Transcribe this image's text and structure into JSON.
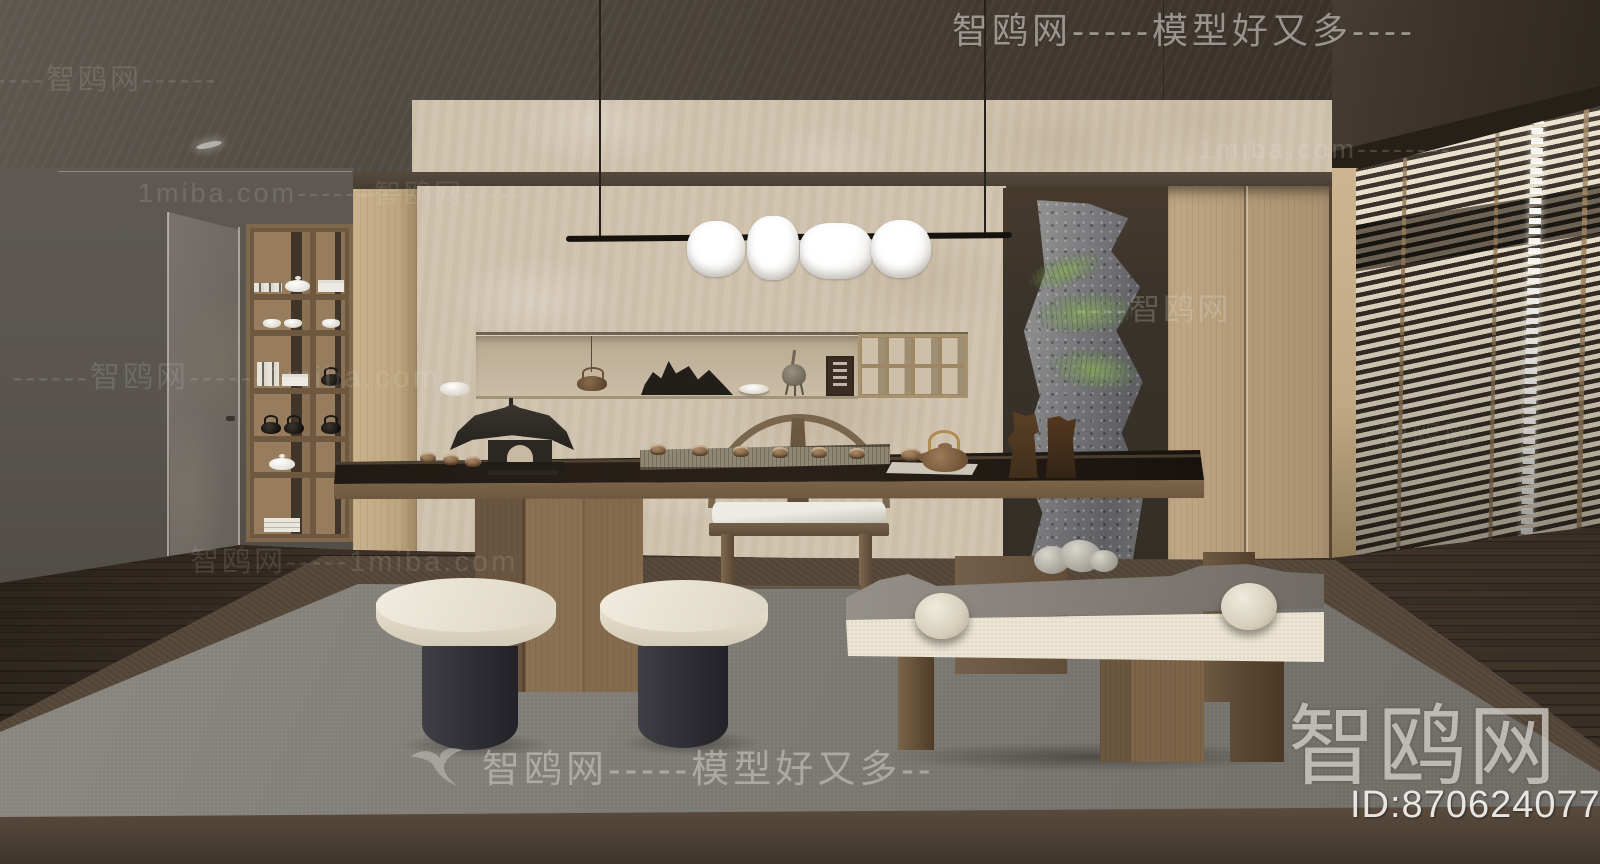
{
  "watermarks": {
    "top_right": "智鸥网-----模型好又多----",
    "bottom_center": {
      "icon": "seagull-icon",
      "text": "智鸥网-----模型好又多--"
    },
    "corner_logo": {
      "site": "智鸥网",
      "model_id": "ID:870624077"
    },
    "tiled": [
      {
        "text": "------智鸥网------"
      },
      {
        "text": "1miba.com----------"
      },
      {
        "text": "-智鸥网-----"
      },
      {
        "text": "1miba.com--------"
      },
      {
        "text": "----智鸥网"
      },
      {
        "text": "------智鸥网------1miba.com"
      },
      {
        "text": "智鸥网-----1miba.com"
      },
      {
        "text": "智鸥网"
      }
    ]
  },
  "palette": {
    "ceilA": "#5c574f",
    "ceilB": "#342d26",
    "wallLeft": "#59544e",
    "wallBeige": "#cfc2ae",
    "bandDark": "#463d31",
    "woodLight": "#c4ac87",
    "cabinet": "#b49c7a",
    "tableTop": "#2a221a",
    "tableWood": "#6a543d",
    "chairWood": "#7a664c",
    "cream": "#d2cab6",
    "stoolBase": "#2c2d33",
    "rugGray": "#7d7a74",
    "rugBorder": "#594b3c",
    "rugFront": "#4a3f33",
    "floorWood": "#3c332a",
    "rockGray": "#5f5f63",
    "plantGreen": "#86a35f",
    "lampWhite": "#ffffff",
    "blindDark": "#261f18",
    "blindLight": "#e9e0cc",
    "wmColor": "#dad7d2"
  },
  "scene": {
    "description": "3D interior render of a Chinese-style tea room",
    "objects": [
      "pendant-lamp",
      "tea-table",
      "horseshoe-armchair",
      "round-stool",
      "round-stool",
      "cushion-bench",
      "bookshelf-cabinet",
      "interior-door",
      "wall-niche-display",
      "pavilion-model",
      "tea-set",
      "scholar-rocks",
      "incense-censer",
      "rock-feature",
      "fern-plant",
      "wardrobe-cabinets",
      "venetian-blinds",
      "wood-floor",
      "gray-rug"
    ]
  }
}
